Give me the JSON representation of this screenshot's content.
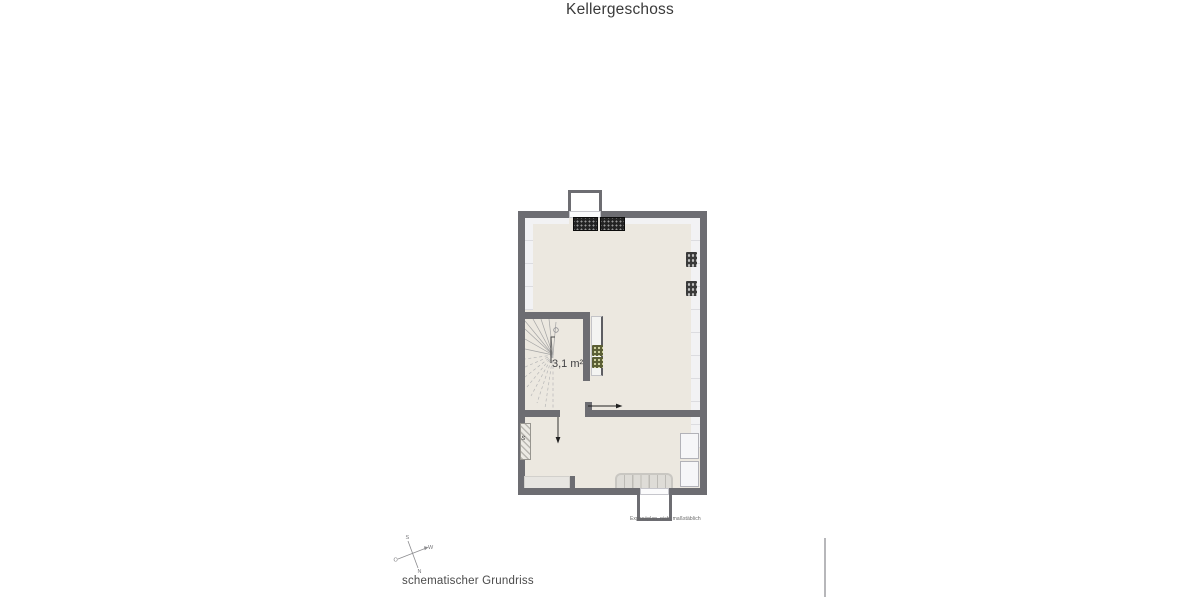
{
  "title": "Kellergeschoss",
  "plan": {
    "room_area_label": "3,1 m²",
    "caption": "Exposéplan, nicht maßstäblich"
  },
  "compass": {
    "north": "N",
    "east": "O",
    "south": "S",
    "west": "W"
  },
  "footer": {
    "label": "schematischer Grundriss"
  },
  "colors": {
    "wall": "#6d6d72",
    "floor": "#ece8e0",
    "band": "#f2f2f4",
    "page": "#ffffff",
    "appliance": "#232323",
    "vent": "#3a3a3a",
    "pipes": "#5a5e34",
    "object": "#e7e5e1",
    "shelf": "#dedcd7",
    "divider": "#b7b7ba",
    "text_dark": "#3a3a3a",
    "text_mid": "#4a4a4a",
    "text_small": "#666666"
  }
}
